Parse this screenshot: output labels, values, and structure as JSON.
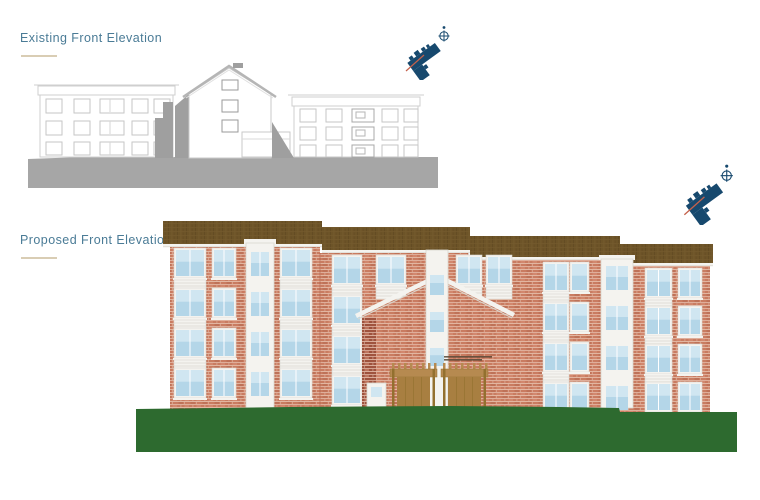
{
  "page": {
    "background": "#ffffff"
  },
  "titles": {
    "existing": "Existing Front Elevation",
    "proposed": "Proposed Front Elevation"
  },
  "icons": {
    "key_plan": "key-plan-icon",
    "north_symbol": "north-symbol-icon",
    "view_direction": "view-direction-line"
  },
  "colors": {
    "teal": "#4a7b96",
    "tan": "#d9cdb4",
    "line_light": "#cfcfcf",
    "line_mid": "#9f9f9f",
    "ground_gray": "#a6a6a6",
    "navy": "#17496e",
    "red_line": "#c4614b",
    "roof_brown": "#6d5428",
    "roof_light": "#7d6134",
    "brick": "#c97c61",
    "brick_light": "#d99178",
    "brick_dark": "#a85a44",
    "brick_return": "#9e523d",
    "mortar": "#e9c4b2",
    "window_blue": "#b4d6e8",
    "window_blue_light": "#d0e6f1",
    "trim_white": "#f4f3ef",
    "trim_line": "#d9d7cf",
    "timber": "#b68a50",
    "timber_dark": "#93702f",
    "door_timber": "#a87f41",
    "grass_green": "#2d6a2f",
    "note_ink": "#4a3a28"
  },
  "specs": {
    "existing": {
      "left_block_floors": 3,
      "left_block_window_columns": 5,
      "central_gable": true,
      "right_block_floors": 3,
      "right_block_window_columns": 5
    },
    "proposed": {
      "storeys": 4,
      "roof_sections": 4,
      "window_bays": 2,
      "stair_core_windows": 3,
      "pergola_canopies": 2,
      "micro_annotation_legible": false
    }
  }
}
